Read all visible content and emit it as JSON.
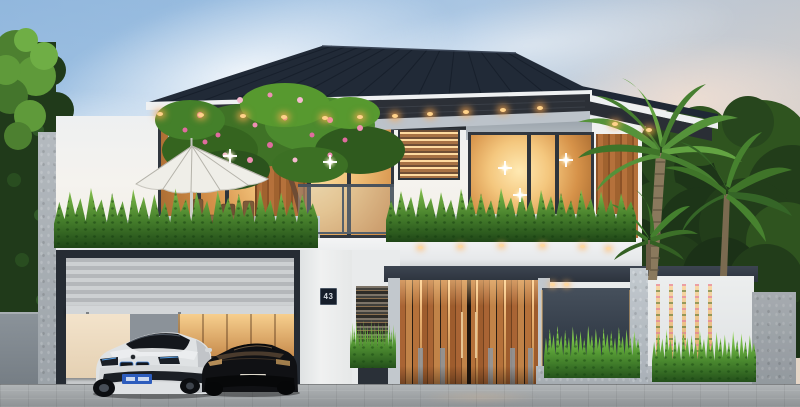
{
  "scene": {
    "title": "Modern two-storey villa exterior - 3D architectural render at dusk",
    "time_of_day": "dusk",
    "house_number": "43"
  },
  "palette": {
    "sky_blue": "#9fc2e3",
    "sky_warm": "#e7d6c6",
    "roof_dark": "#212a37",
    "fascia_white": "#eff1f2",
    "soffit_dark": "#2c3037",
    "wall_white": "#f2f1ee",
    "wood_cladding": "#a96a38",
    "window_glow": "#f2c27a",
    "window_frame": "#31373f",
    "foliage_dark": "#1d3518",
    "foliage_mid": "#47802c",
    "foliage_light": "#9ccf5e",
    "flower_pink": "#ef8fb4",
    "planter_concrete": "#a9b2b7",
    "garage_shutter": "#c5c8ca",
    "gate_wood": "#b5713a",
    "gate_backlight": "#ffd9a0",
    "fence_dark": "#39424e",
    "fence_white": "#e9ebec",
    "street_grey": "#9b9fa2",
    "car_white": "#dfe2e4",
    "car_black": "#101114",
    "plate_blue": "#2d5dbd",
    "downlight_warm": "#ffd28a"
  },
  "objects": {
    "vehicles": [
      "white luxury sports coupe in garage",
      "black sports car in garage"
    ],
    "vehicle_plates": [
      "blue plate, characters illegible",
      "white plate, characters illegible"
    ],
    "vegetation": [
      "frangipani tree with pink blossoms",
      "balcony fern planters",
      "tall palm trees",
      "clipped hedge wall",
      "bougainvillea behind fence slits"
    ],
    "features": [
      "dark hip roof with recessed downlights",
      "white patio umbrella with wooden chairs",
      "glass balcony railing",
      "roller-shutter garage door, half open",
      "vertical wood-slat entry gate, backlit",
      "dark fence panel",
      "white fence panel with lit slits",
      "concrete gate pillars",
      "paved street"
    ]
  }
}
